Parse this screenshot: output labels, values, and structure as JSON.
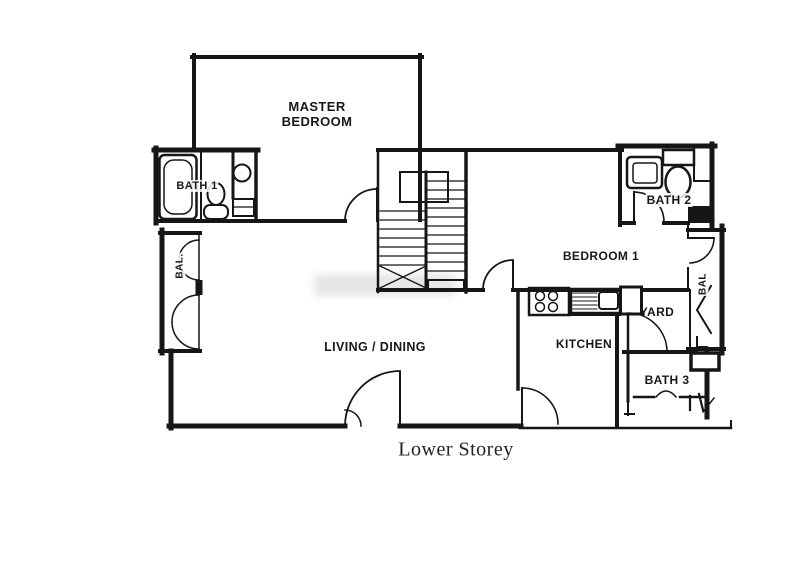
{
  "floor_plan": {
    "caption": "Lower Storey",
    "rooms": {
      "master_bedroom": "MASTER BEDROOM",
      "bath1": "BATH 1",
      "bath2": "BATH 2",
      "bath3": "BATH 3",
      "bedroom1": "BEDROOM 1",
      "living_dining": "LIVING / DINING",
      "kitchen": "KITCHEN",
      "yard": "YARD",
      "balcony_left": "BAL.",
      "balcony_right": "BAL"
    },
    "fixtures": [
      "bathtub-icon",
      "toilet-icon",
      "wash-basin-icon",
      "stove-icon",
      "kitchen-sink-icon",
      "staircase",
      "door-arc",
      "bifold-door-icon"
    ],
    "colors": {
      "wall": "#161616",
      "background": "#ffffff",
      "watermark": "#bebebe"
    }
  }
}
